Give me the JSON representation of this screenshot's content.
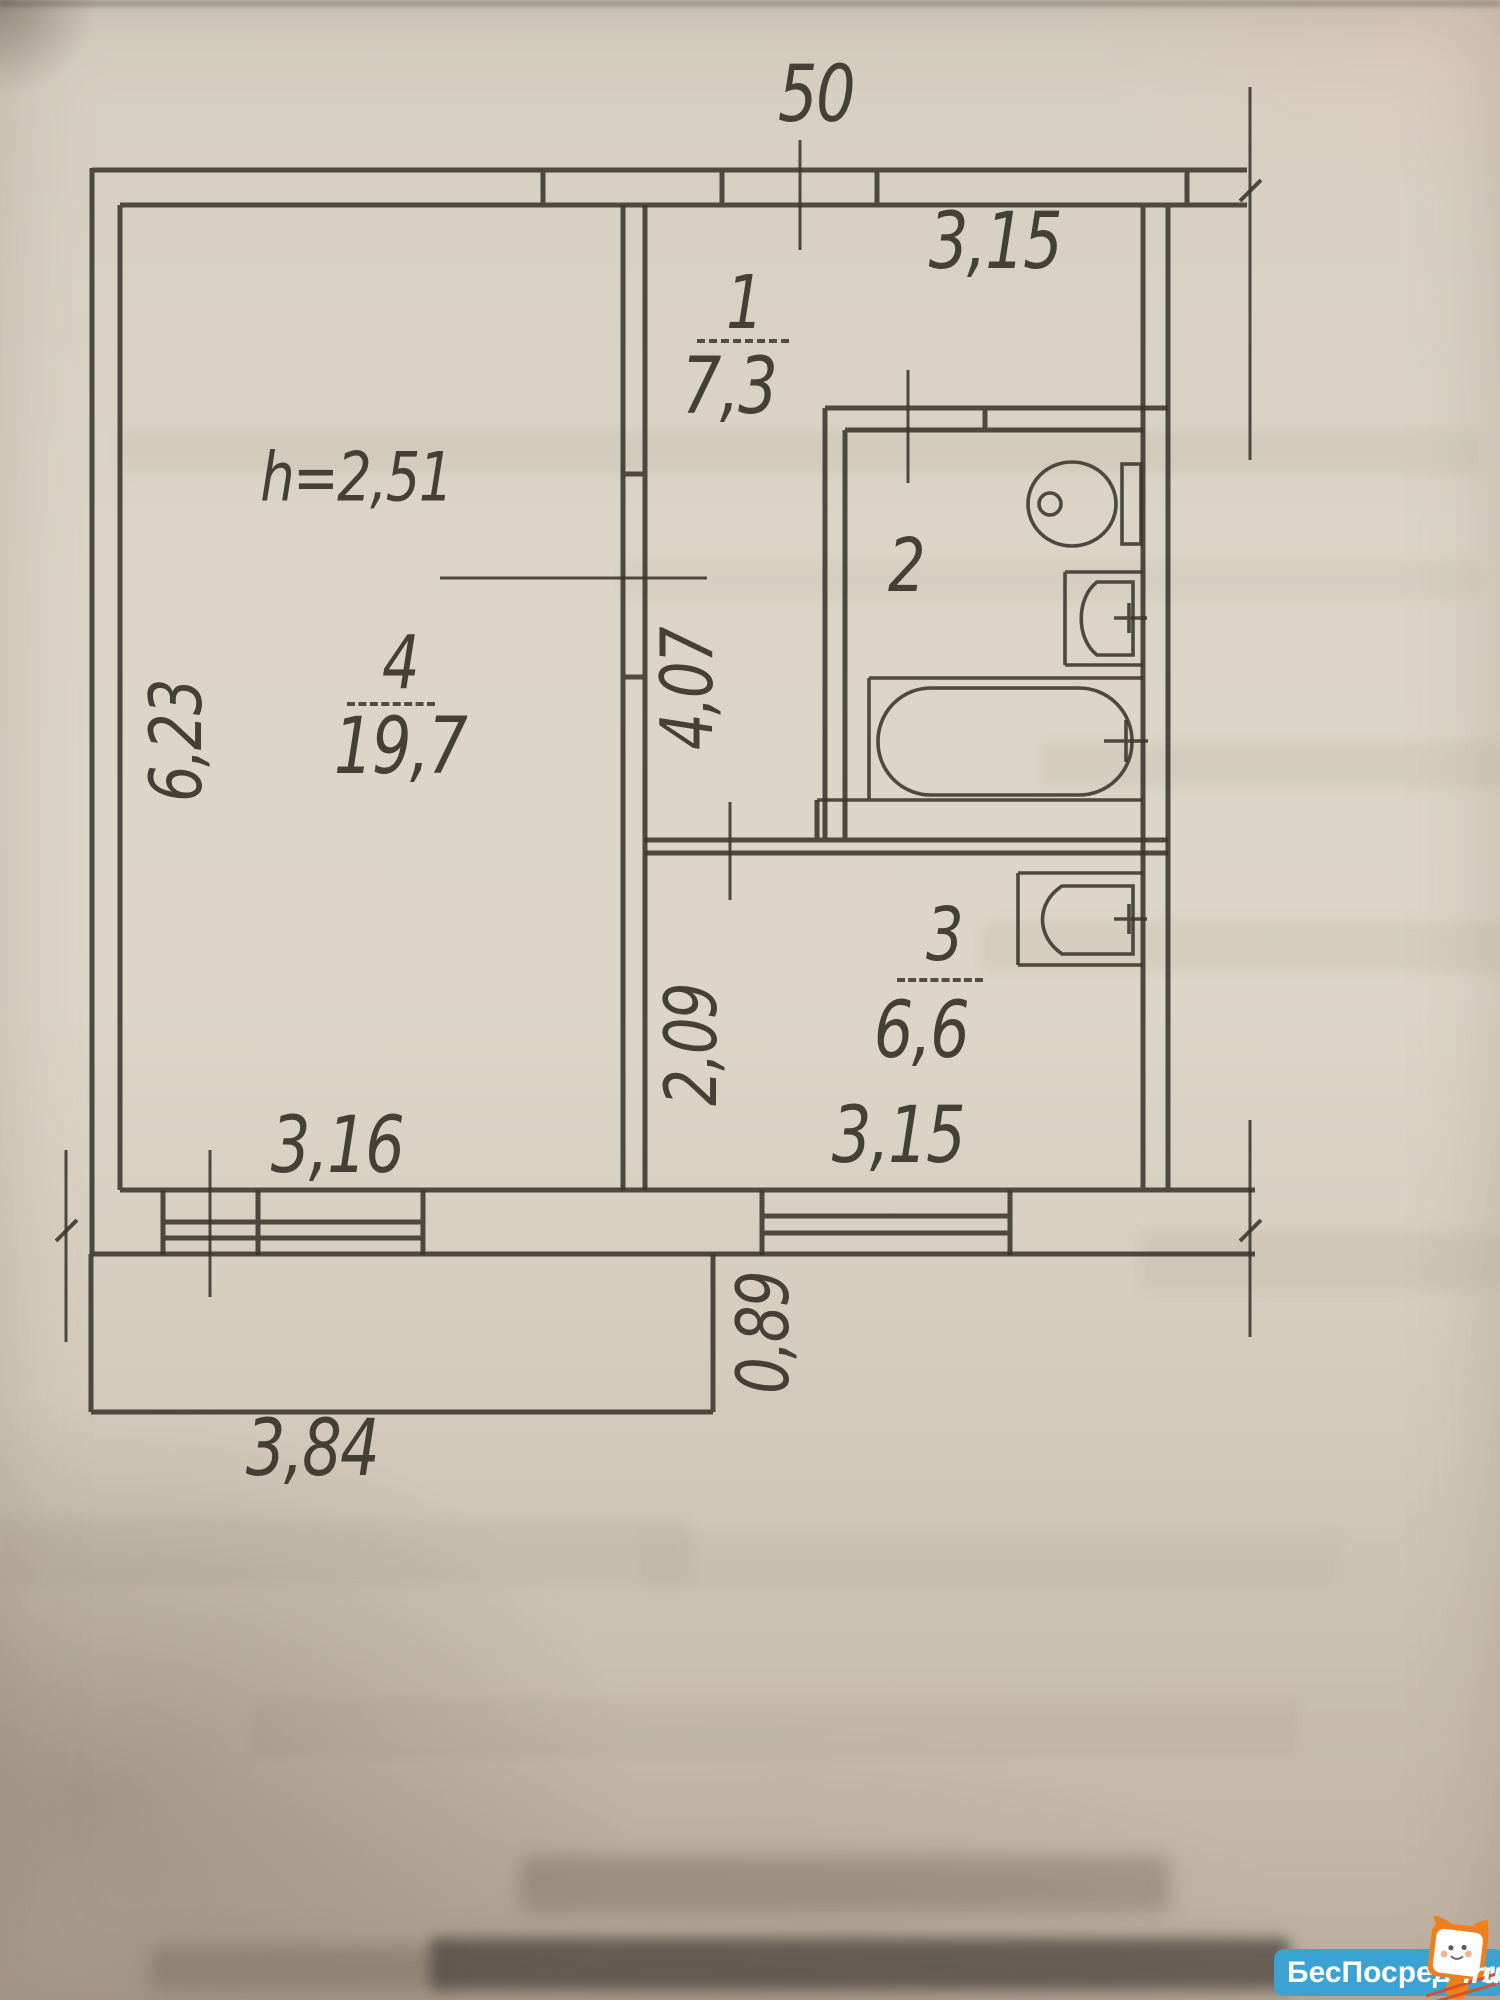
{
  "plan": {
    "ceiling_height": "h=2,51",
    "rooms": [
      {
        "number": "1",
        "area": "7,3"
      },
      {
        "number": "2"
      },
      {
        "number": "3",
        "area": "6,6"
      },
      {
        "number": "4",
        "area": "19,7"
      }
    ],
    "dims": {
      "top_small": "50",
      "top_right": "3,15",
      "left_height": "6,23",
      "hall_vertical": "4,07",
      "lower_left_vertical": "2,09",
      "bottom_left": "3,16",
      "bottom_right": "3,15",
      "balcony_depth": "0,89",
      "balcony_width": "3,84"
    },
    "colors": {
      "ink": "#3a352b",
      "paper": "#d9d2c4"
    },
    "fixtures": [
      "toilet",
      "washbasin",
      "bathtub",
      "washbasin"
    ]
  },
  "watermark": {
    "name": "БесПосредника",
    "tld": ".ru",
    "colors": {
      "pill": "#3ba3d3",
      "mascot": "#ef7f1b",
      "text": "#ffffff"
    }
  }
}
